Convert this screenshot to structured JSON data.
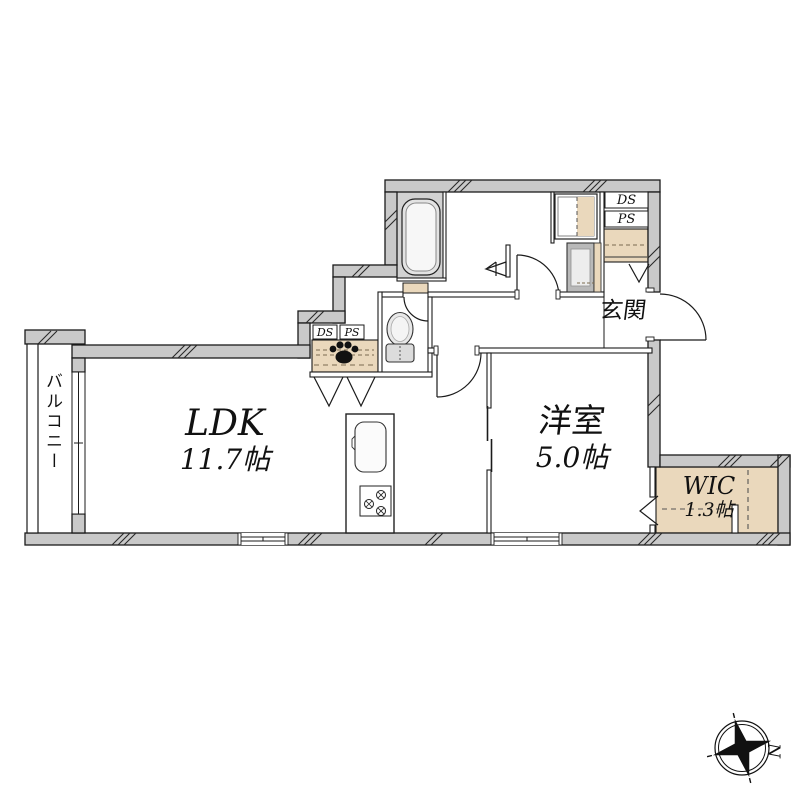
{
  "floorplan": {
    "rooms": {
      "ldk": {
        "name": "LDK",
        "size": "11.7帖"
      },
      "bedroom": {
        "name": "洋室",
        "size": "5.0帖"
      },
      "wic": {
        "name": "WIC",
        "size": "1.3帖"
      },
      "entrance": {
        "name": "玄関"
      },
      "balcony": {
        "name": "バルコニー"
      }
    },
    "ducts": {
      "ds_upper": "DS",
      "ps_upper": "PS",
      "ds_closet": "DS",
      "ps_closet": "PS"
    },
    "compass": {
      "north": "N"
    },
    "colors": {
      "wall_fill": "#c9c9c9",
      "storage_fill": "#ead8bc",
      "bath_floor": "#d2d2d2",
      "line": "#1b1b1b"
    }
  }
}
